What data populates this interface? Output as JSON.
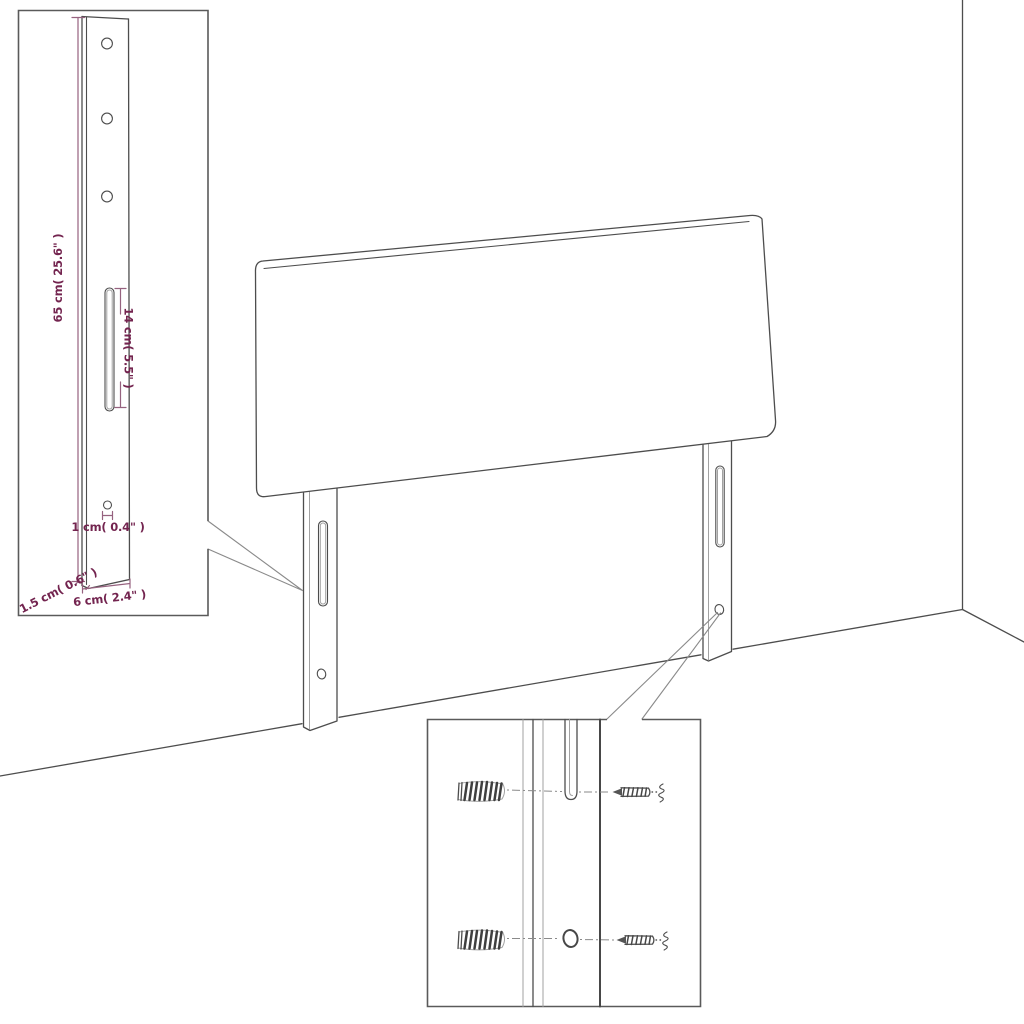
{
  "diagram": {
    "type": "product-dimension-diagram",
    "subject": "headboard with two mounting legs shown against a wall corner, with enlarged leg detail and wall-fixing detail insets"
  },
  "colors": {
    "outline": "#4d4d4d",
    "outline-light": "#a2a2a2",
    "dim-line": "#96627f",
    "dim-text": "#73244f",
    "inset-border": "#5a5a5a",
    "bg": "#ffffff"
  },
  "dimensions": {
    "leg_height": {
      "label": "65 cm( 25.6\" )"
    },
    "slot_length": {
      "label": "14 cm( 5.5\" )"
    },
    "hole_diameter": {
      "label": "1 cm( 0.4\" )"
    },
    "leg_depth": {
      "label": "1.5 cm( 0.6\" )"
    },
    "leg_width": {
      "label": "6 cm( 2.4\" )"
    }
  }
}
